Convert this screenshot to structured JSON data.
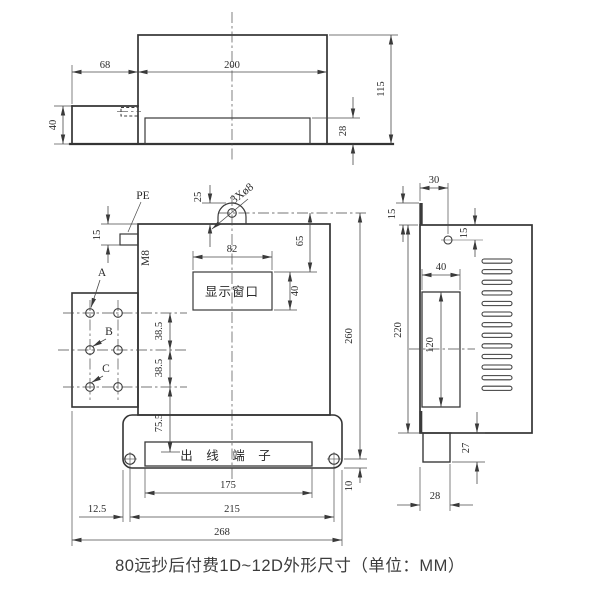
{
  "caption": "80远抄后付费1D~12D外形尺寸（单位：MM）",
  "colors": {
    "line": "#3a3a3a",
    "background": "#ffffff"
  },
  "top_view": {
    "d68": "68",
    "d200": "200",
    "d115": "115",
    "d40": "40",
    "d28": "28"
  },
  "front_view": {
    "pe_label": "PE",
    "m8_label": "M8",
    "hole_note": "3Xø8",
    "window_label": "显示窗口",
    "terminal_label": "出 线 端 子",
    "phase_a": "A",
    "phase_b": "B",
    "phase_c": "C",
    "d25": "25",
    "d15": "15",
    "d82": "82",
    "d65": "65",
    "d40": "40",
    "d38": "38.5",
    "d75": "75.5",
    "d260": "260",
    "d10": "10",
    "d175": "175",
    "d215": "215",
    "d12_5": "12.5",
    "d268": "268"
  },
  "side_view": {
    "d30": "30",
    "d15_top": "15",
    "d15_hole": "15",
    "d220": "220",
    "d40": "40",
    "d120": "120",
    "d27": "27",
    "d28": "28"
  }
}
